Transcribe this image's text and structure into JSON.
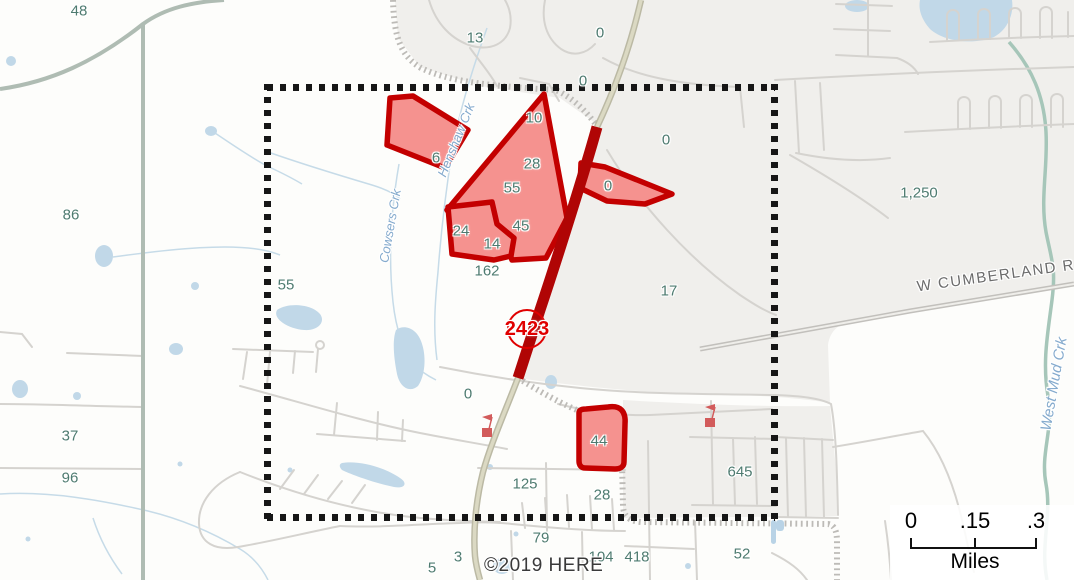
{
  "map": {
    "attribution": "©2019 HERE",
    "scale_bar": {
      "ticks": [
        "0",
        ".15",
        ".3"
      ],
      "unit_label": "Miles"
    },
    "route_shield": {
      "number": "2423"
    },
    "labels": {
      "road": [
        {
          "text": "W CUMBERLAND RD",
          "x": 1002,
          "y": 275,
          "rotate": -8
        }
      ],
      "water": [
        {
          "text": "Henshaw Crk",
          "x": 456,
          "y": 140,
          "rotate": -68,
          "size": 13
        },
        {
          "text": "Cowsers Crk",
          "x": 390,
          "y": 226,
          "rotate": -80,
          "size": 13
        },
        {
          "text": "West Mud Crk",
          "x": 1054,
          "y": 384,
          "rotate": -80,
          "size": 15
        }
      ],
      "parcel": [
        {
          "text": "48",
          "x": 79,
          "y": 11
        },
        {
          "text": "86",
          "x": 71,
          "y": 215
        },
        {
          "text": "55",
          "x": 286,
          "y": 285
        },
        {
          "text": "37",
          "x": 70,
          "y": 436
        },
        {
          "text": "96",
          "x": 70,
          "y": 478
        },
        {
          "text": "13",
          "x": 475,
          "y": 38
        },
        {
          "text": "0",
          "x": 600,
          "y": 33
        },
        {
          "text": "0",
          "x": 583,
          "y": 81
        },
        {
          "text": "0",
          "x": 666,
          "y": 140
        },
        {
          "text": "1,250",
          "x": 919,
          "y": 193
        },
        {
          "text": "6",
          "x": 436,
          "y": 158
        },
        {
          "text": "10",
          "x": 534,
          "y": 118
        },
        {
          "text": "28",
          "x": 532,
          "y": 164
        },
        {
          "text": "55",
          "x": 512,
          "y": 188
        },
        {
          "text": "45",
          "x": 521,
          "y": 226
        },
        {
          "text": "24",
          "x": 461,
          "y": 231
        },
        {
          "text": "14",
          "x": 492,
          "y": 244
        },
        {
          "text": "0",
          "x": 608,
          "y": 186
        },
        {
          "text": "162",
          "x": 487,
          "y": 271
        },
        {
          "text": "17",
          "x": 669,
          "y": 291
        },
        {
          "text": "0",
          "x": 468,
          "y": 394
        },
        {
          "text": "44",
          "x": 599,
          "y": 441
        },
        {
          "text": "125",
          "x": 525,
          "y": 484
        },
        {
          "text": "28",
          "x": 602,
          "y": 495
        },
        {
          "text": "645",
          "x": 740,
          "y": 472
        },
        {
          "text": "79",
          "x": 541,
          "y": 538
        },
        {
          "text": "3",
          "x": 458,
          "y": 557
        },
        {
          "text": "5",
          "x": 432,
          "y": 568
        },
        {
          "text": "104",
          "x": 601,
          "y": 557
        },
        {
          "text": "418",
          "x": 637,
          "y": 557
        },
        {
          "text": "52",
          "x": 742,
          "y": 554
        }
      ]
    },
    "colors": {
      "selection_fill": "#F5928F",
      "selection_outline": "#C30000",
      "highlight_road": "#B00505",
      "shield_red": "#E00000",
      "boundary_black": "#161616",
      "label_teal": "#4E7B70",
      "water_blue": "#C1D8E8",
      "water_label_blue": "#84AACD",
      "marker_red": "#D25B5B"
    }
  }
}
